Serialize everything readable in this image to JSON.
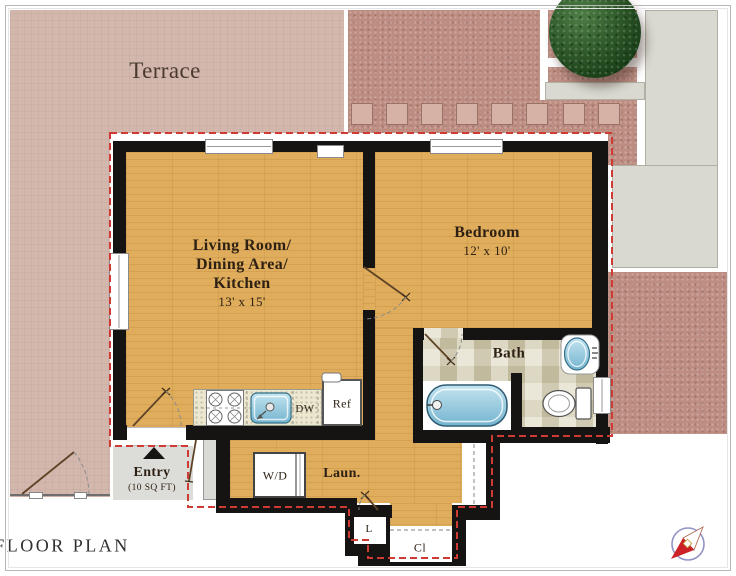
{
  "title": "FLOOR PLAN",
  "outdoor": {
    "terrace_label": "Terrace"
  },
  "rooms": {
    "living": {
      "name_lines": [
        "Living Room/",
        "Dining Area/",
        "Kitchen"
      ],
      "dims": "13' x 15'"
    },
    "bedroom": {
      "name": "Bedroom",
      "dims": "12' x 10'"
    },
    "bath": {
      "name": "Bath"
    },
    "laundry": {
      "name": "Laun."
    },
    "entry": {
      "name": "Entry",
      "area": "(10 SQ FT)"
    },
    "linen": {
      "name": "L"
    },
    "closet": {
      "name": "Cl"
    }
  },
  "fixtures": {
    "washer_dryer": "W/D",
    "dishwasher": "DW",
    "refrigerator": "Ref"
  },
  "colors": {
    "boundary_red": "#cf3b34",
    "wall_black": "#161413",
    "wood_floor": "#e0ad5c",
    "terrace_mauve": "#d3b7ad",
    "pavement_pink": "#bd8d82",
    "walkway_gray": "#d9d9d1",
    "water_blue": "#8fc3d9",
    "tree_green": "#2c5527"
  }
}
